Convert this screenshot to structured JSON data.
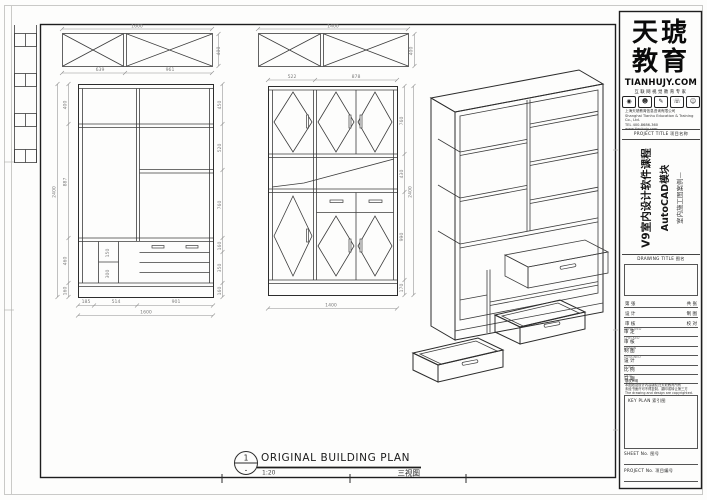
{
  "brand": {
    "name_line1": "天琥",
    "name_line2": "教育",
    "site": "TIANHUJY.COM",
    "tagline": "互联网视觉教育专家",
    "icons": [
      "◉",
      "☻",
      "✎",
      "☏",
      "☺"
    ],
    "company_lines": [
      "上海天琥教育信息咨询有限公司",
      "Shanghai Tianhu Education & Training Co., Ltd.",
      "TEL 400-8686-360",
      "www.tianhujy.com"
    ]
  },
  "titleblock": {
    "project_title_caption": "PROJECT TITLE 项目名称",
    "project_title_main": "V9室内设计软件课程",
    "project_title_sub": "AutoCAD模块",
    "project_title_note": "室内施工图案例—",
    "drawing_title_caption": "DRAWING TITLE 图名",
    "pair_rows": [
      {
        "l": "第  张",
        "r": "共  张"
      },
      {
        "l": "设  计",
        "r": "制  图"
      },
      {
        "l": "审  核",
        "r": "校  对"
      }
    ],
    "caption_rows": [
      {
        "en": "APPROVED",
        "zh": "审 定"
      },
      {
        "en": "CHECKED",
        "zh": "审 核"
      },
      {
        "en": "DRAWN",
        "zh": "制 图"
      },
      {
        "en": "DESIGNED",
        "zh": "设 计"
      },
      {
        "en": "SCALE",
        "zh": "比 例"
      },
      {
        "en": "DATE",
        "zh": "日 期"
      }
    ],
    "notes": [
      "版权声明",
      "本图纸及设计内容版权归天琥教育所有",
      "未经书面许可不得复制、翻印或转让第三方",
      "The drawing and design are copyrighted."
    ],
    "key_plan_caption": "KEY PLAN 索引图",
    "sheet_no_caption": "SHEET No. 图号",
    "project_no_caption": "PROJECT No. 项目编号"
  },
  "view_label": {
    "bubble_number": "1",
    "bubble_ref": "-",
    "title": "ORIGINAL BUILDING PLAN",
    "scale": "1:20",
    "caption": "三视图"
  },
  "dims": {
    "tv1_total": "1600",
    "tv1_seg1": "639",
    "tv1_seg2": "961",
    "tv1_depth": "400",
    "tv2_total": "1400",
    "tv2_depth": "400",
    "el1_total_w": "1600",
    "el1_total_h": "2400",
    "el1_b1": "185",
    "el1_b2": "514",
    "el1_b3": "901",
    "el1_l1": "400",
    "el1_l2": "887",
    "el1_l3": "460",
    "el1_l4": "160",
    "el1_r1": "450",
    "el1_r2": "520",
    "el1_r3": "760",
    "el1_r4": "160",
    "el1_r5": "350",
    "el1_r6": "160",
    "el1_c1": "150",
    "el1_c2": "300",
    "el2_t1": "522",
    "el2_t2": "878",
    "el2_total_w": "1400",
    "el2_total_h": "2400",
    "el2_r1": "760",
    "el2_r2": "430",
    "el2_r3": "990",
    "el2_r4": "170"
  }
}
